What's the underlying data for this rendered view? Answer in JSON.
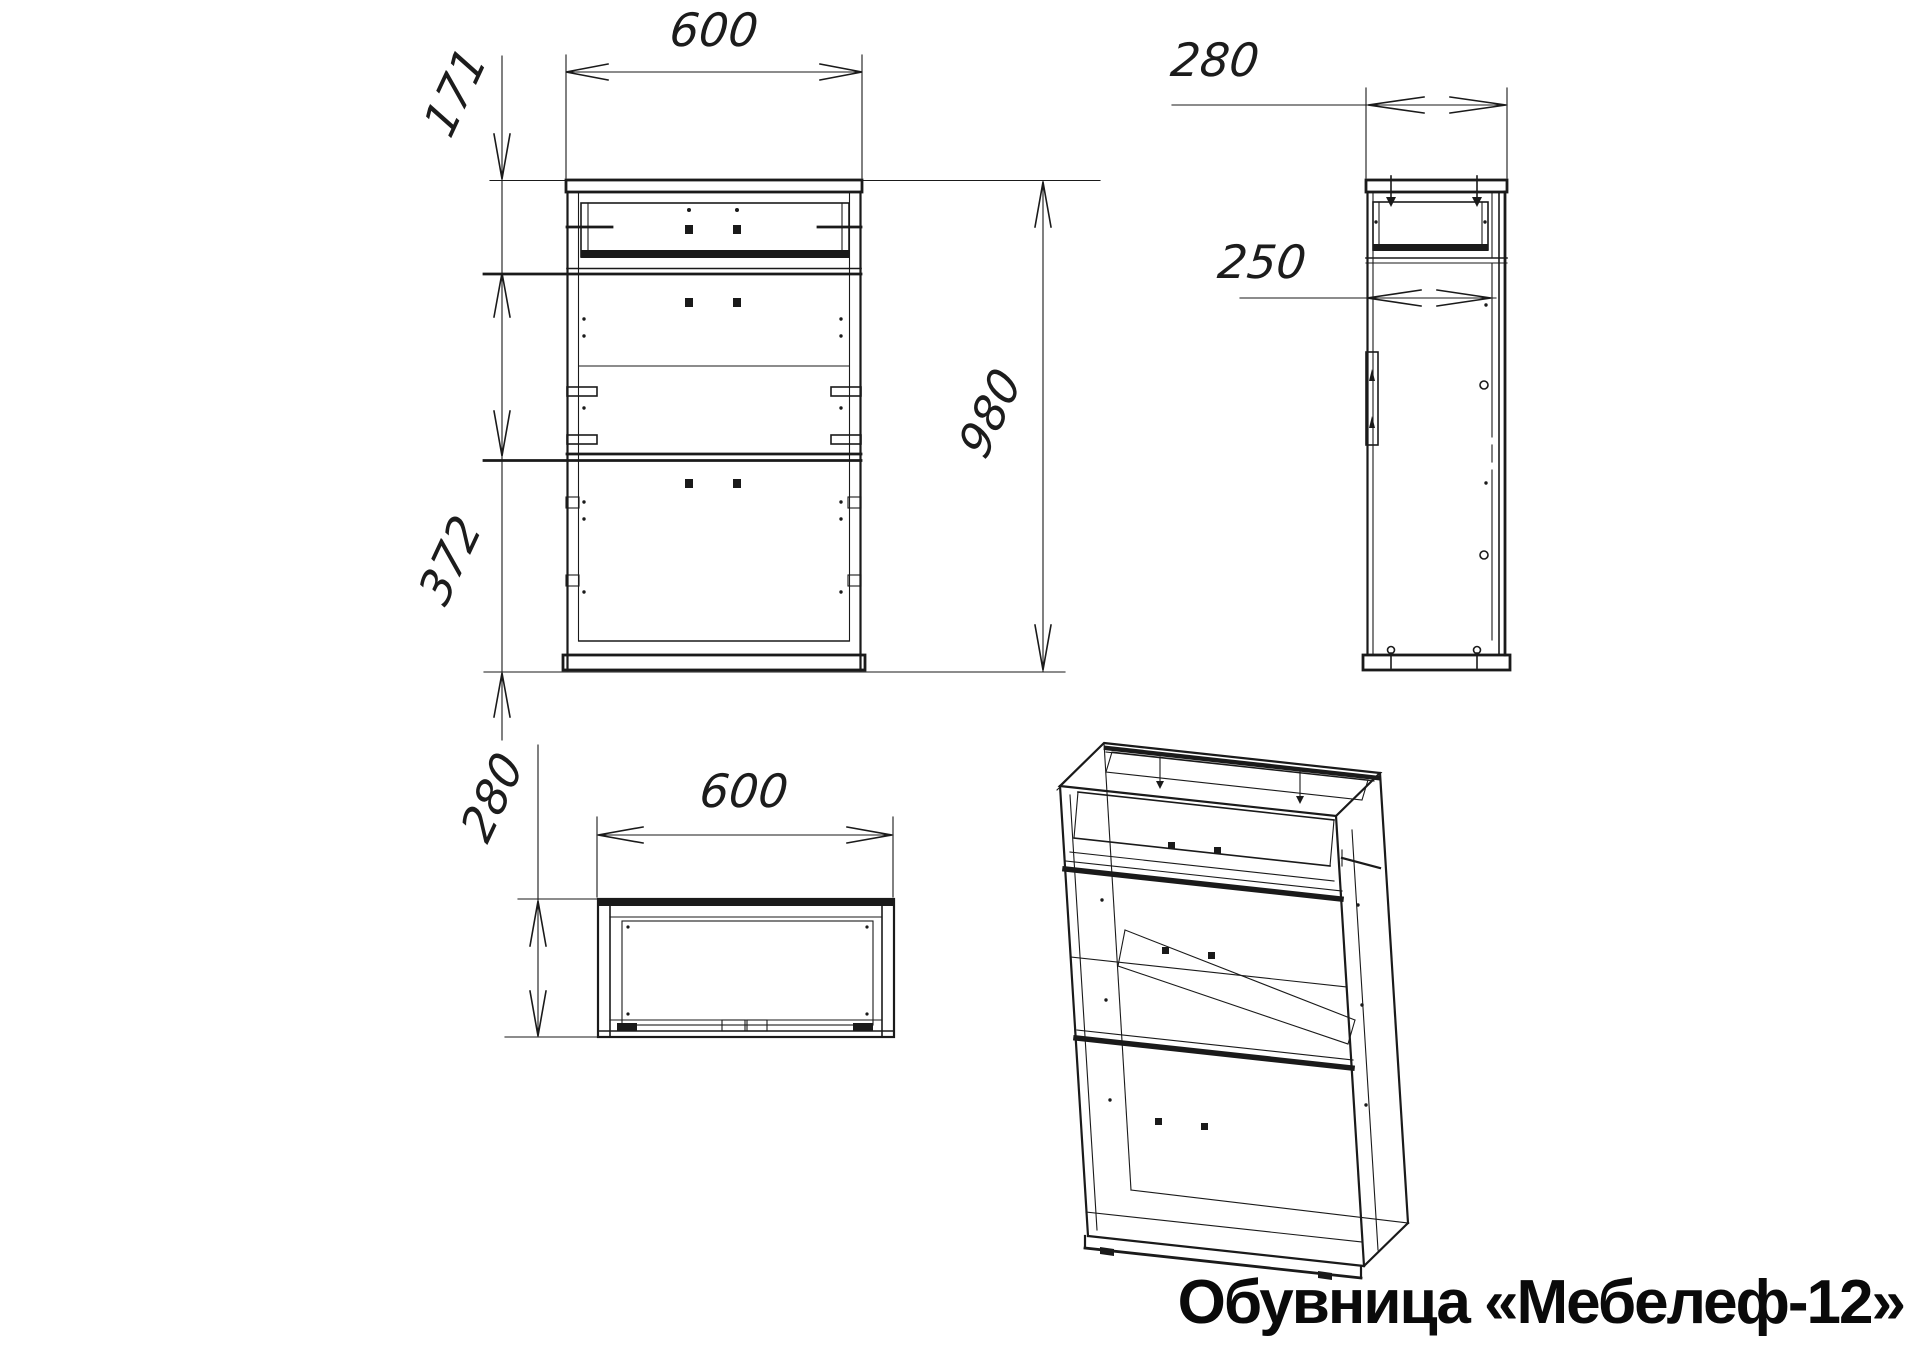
{
  "title": "Обувница «Мебелеф-12»",
  "colors": {
    "background": "#ffffff",
    "line": "#1a1a1a"
  },
  "views": {
    "front": {
      "label_width": "600",
      "label_top_section_height": "171",
      "label_bottom_section_height": "372",
      "label_total_height": "980"
    },
    "side": {
      "label_depth": "280",
      "label_inner_depth": "250"
    },
    "top": {
      "label_width": "600",
      "label_depth": "280"
    }
  }
}
